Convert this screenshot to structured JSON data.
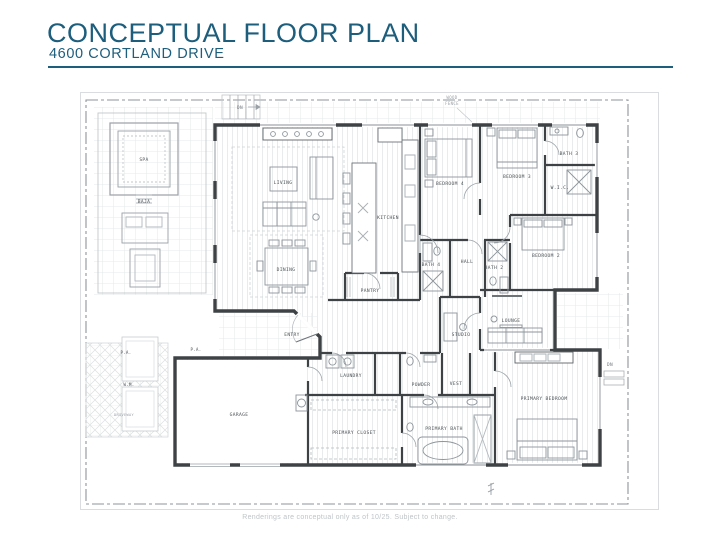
{
  "header": {
    "title": "CONCEPTUAL FLOOR PLAN",
    "subtitle": "4600 CORTLAND DRIVE"
  },
  "colors": {
    "accent": "#1d5e7d",
    "wall": "#3e4245",
    "furniture_line": "#8d959b",
    "hatch": "#e7eaeb",
    "site_line": "#8e959a",
    "label_text": "#4b5054"
  },
  "rooms": {
    "living": "LIVING",
    "kitchen": "KITCHEN",
    "dining": "DINING",
    "pantry": "PANTRY",
    "entry": "ENTRY",
    "bedroom4": "BEDROOM 4",
    "bedroom3": "BEDROOM 3",
    "bath3": "BATH 3",
    "wic": "W.I.C.",
    "bedroom2": "BEDROOM 2",
    "bath4": "BATH 4",
    "hall": "HALL",
    "bath2": "BATH 2",
    "lounge": "LOUNGE",
    "studio": "STUDIO",
    "garage": "GARAGE",
    "laundry": "LAUNDRY",
    "powder": "POWDER",
    "vest": "VEST",
    "primary_closet": "PRIMARY CLOSET",
    "primary_bath": "PRIMARY BATH",
    "primary_bedroom": "PRIMARY BEDROOM",
    "spa": "SPA",
    "baja": "BAJA"
  },
  "annotations": {
    "dn": "DN",
    "wood": "WOOD",
    "fence": "FENCE",
    "pa": "P.A.",
    "wm": "W.M.",
    "driveway": "DRIVEWAY"
  },
  "footer": {
    "disclaimer": "Renderings are conceptual only as of 10/25.  Subject to change."
  }
}
